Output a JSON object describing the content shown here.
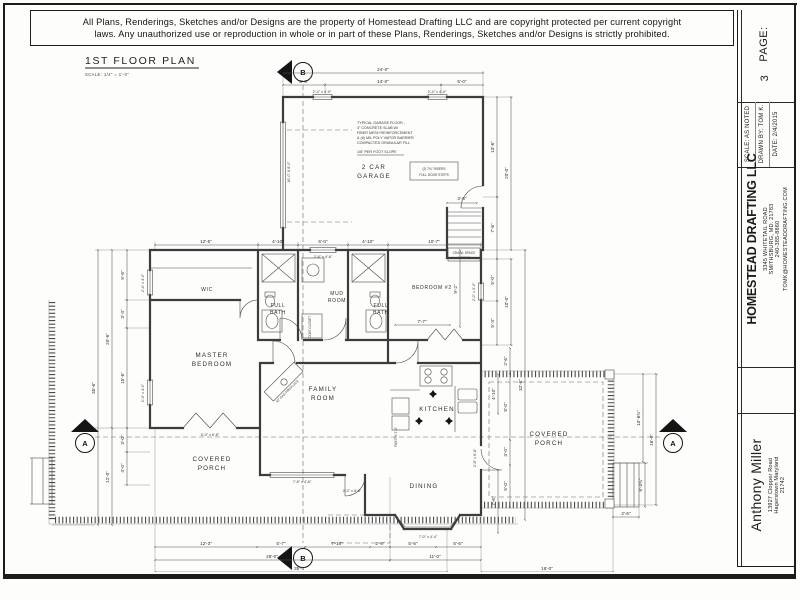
{
  "copyright": {
    "line1": "All Plans, Renderings, Sketches and/or Designs are the property of Homestead Drafting LLC and are copyright protected per current copyright",
    "line2": "laws. Any unauthorized use or reproduction in whole or in part of these Plans, Renderings, Sketches and/or Designs is strictly prohibited."
  },
  "titleblock": {
    "page_label": "PAGE:",
    "page_number": "3",
    "scale": "SCALE:  AS NOTED",
    "drawn_by": "DRAWN BY:  TOM K.",
    "date": "DATE:  2/4/2015",
    "company": "HOMESTEAD DRAFTING LLC",
    "address1": "3345 WHITETAIL ROAD",
    "address2": "SMITHSBURG, MD. 21783",
    "phone": "240-385-8860",
    "email": "TOMK@HOMESTEADDRAFTING.COM",
    "client_name": "Anthony Miller",
    "client_address1": "13927 Clopper Road",
    "client_address2": "Hagerstown    Maryland",
    "client_zip": "21742"
  },
  "plan": {
    "title": "1ST FLOOR PLAN",
    "scale_note": "SCALE:   1/4\" = 1'-0\"",
    "rooms": {
      "garage1": "2 CAR",
      "garage2": "GARAGE",
      "wic": "WIC",
      "bath_a": "FULL",
      "bath_b": "BATH",
      "mud1": "MUD",
      "mud2": "ROOM",
      "bedroom2": "BEDROOM #2",
      "master1": "MASTER",
      "master2": "BEDROOM",
      "family1": "FAMILY",
      "family2": "ROOM",
      "kitchen": "KITCHEN",
      "dining": "DINING",
      "porch1": "COVERED",
      "porch2": "PORCH",
      "pantry": "PANTRY 2'-0\"",
      "coat": "COAT CLOSET"
    },
    "notes": {
      "g1": "TYPICAL GARAGE FLOOR -",
      "g2": "4\" CONCRETE SLAB W/",
      "g3": "FIBER MESH REINFORCEMENT",
      "g4": "& (6) MIL POLY VAPOR BARRIER",
      "g5": "COMPACTED GRANULAR FILL",
      "slope": "1/8\" PER FOOT SLOPE",
      "riser1": "(2) 7¾\" RISERS",
      "riser2": "FULL DOOR STEPS",
      "crawl1": "CRAWL SPACE",
      "crawl2": "ACCESS",
      "fireplace": "42\" GAS FIREPLACE"
    },
    "markers": {
      "a": "A",
      "b": "B"
    },
    "dims": {
      "24-0": "24'-0\"",
      "14-0": "14'-0\"",
      "5-0": "5'-0\"",
      "2-4x4-0": "2'-4\" x 4'-0\"",
      "2-8x4-6": "2'-8\" x 4'-6\"",
      "16-0x8-0": "16'-0\" X 8'-0\"",
      "12-5": "12'-5\"",
      "4-10": "4'-10\"",
      "6-0": "6'-0\"",
      "10-7": "10'-7\"",
      "13-6": "13'-6\"",
      "20-0": "20'-0\"",
      "3-6": "3'-6\"",
      "7-6": "7'-6\"",
      "5-3": "5'-3\"",
      "10-0": "10'-0\"",
      "32-6": "32'-6\"",
      "9-2": "9'-2\"",
      "7-7": "7'-7\"",
      "2-0x3-0": "2'-0\" x 3'-0\"",
      "35-6": "35'-6\"",
      "20-6": "20'-6\"",
      "5-6": "5'-6\"",
      "3-4": "3'-4\"",
      "15-6": "15'-6\"",
      "3-0": "3'-0\"",
      "4-0": "4'-0\"",
      "12-0": "12'-0\"",
      "12-3": "12'-3\"",
      "5-7": "5'-7\"",
      "7-10": "7'-10\"",
      "2-4": "2'-4\"",
      "28-0": "28'-0\"",
      "11-0": "11'-0\"",
      "35-0": "35'-0\"",
      "16-0": "16'-0\"",
      "2-6": "2'-6\"",
      "8-0": "8'-0\"",
      "10-6": "10'-6¾\"",
      "6-3": "6'-3¾\"",
      "6-0x6-8": "6'-0\" x 6'-8\"",
      "7-8x4-6": "7'-8\" x 4'-6\"",
      "2-0x6-8": "2'-0\" x 6'-8\"",
      "2-8x6-8": "2'-8\" x 6'-8\"",
      "7-0x4-4": "7'-0\" x 4'-4\""
    }
  }
}
